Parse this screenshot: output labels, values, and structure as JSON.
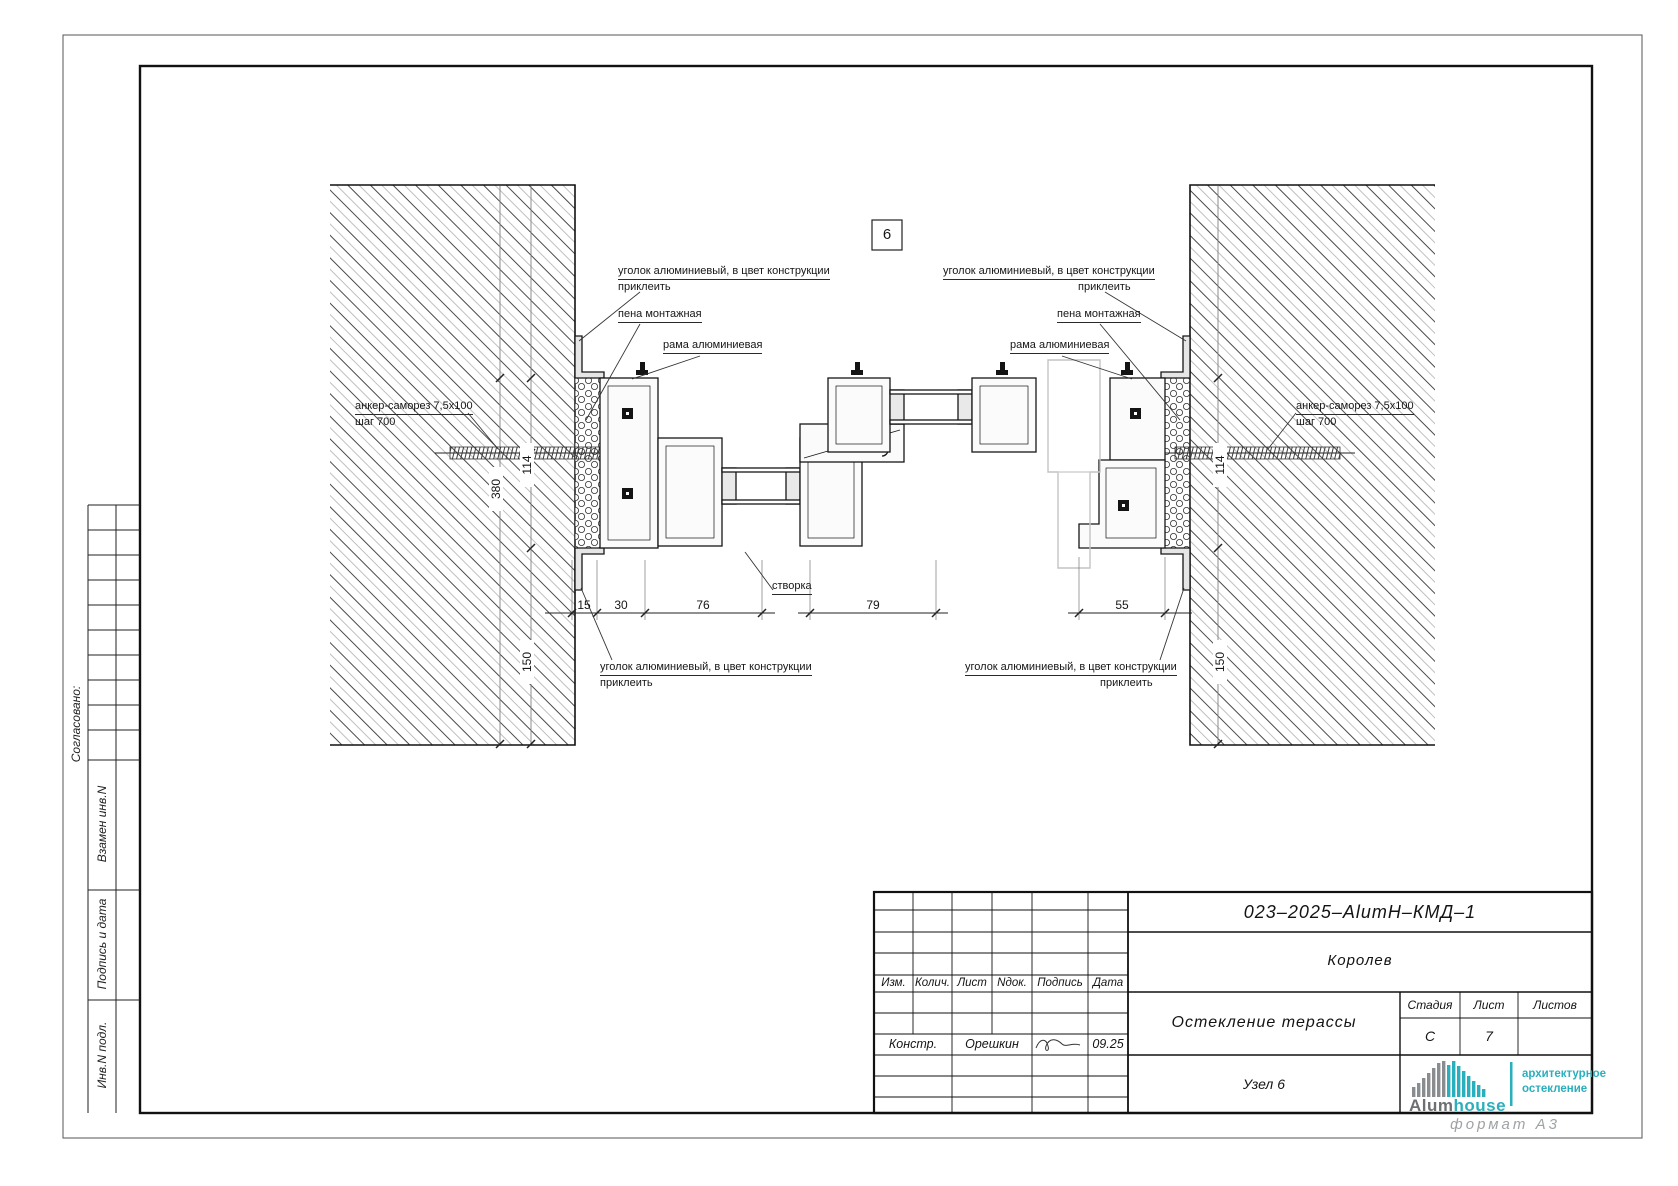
{
  "drawing": {
    "callout": "6",
    "labels": {
      "corner": "уголок алюминиевый, в цвет конструкции",
      "glue": "приклеить",
      "foam": "пена монтажная",
      "frame": "рама алюминиевая",
      "anchor": "анкер-саморез 7,5х100",
      "anchor_step": "шаг 700",
      "sash": "створка"
    },
    "dimensions": {
      "w15": "15",
      "w30": "30",
      "w76": "76",
      "w79": "79",
      "w55": "55",
      "wall": "380",
      "h114": "114",
      "h150": "150"
    }
  },
  "side_stamps": {
    "agreed": "Согласовано:",
    "replace_inv": "Взамен инв.N",
    "sign_date": "Подпись и дата",
    "inv_orig": "Инв.N подл."
  },
  "titleblock": {
    "doc_code": "023–2025–AlumH–КМД–1",
    "project": "Королев",
    "title": "Остекление терассы",
    "node": "Узел 6",
    "headers": {
      "izm": "Изм.",
      "kolich": "Колич.",
      "list": "Лист",
      "ndok": "Nдок.",
      "podpis": "Подпись",
      "data": "Дата"
    },
    "stage_label": "Стадия",
    "sheet_label": "Лист",
    "sheets_label": "Листов",
    "stage": "С",
    "sheet": "7",
    "sheets": "",
    "role": "Констр.",
    "designer": "Орешкин",
    "date": "09.25"
  },
  "logo": {
    "brand_gray": "Alum",
    "brand_teal": "house",
    "tag1": "архитектурное",
    "tag2": "остекление",
    "teal": "#2AAFBC",
    "gray": "#808285"
  },
  "footer": {
    "format": "формат А3"
  }
}
